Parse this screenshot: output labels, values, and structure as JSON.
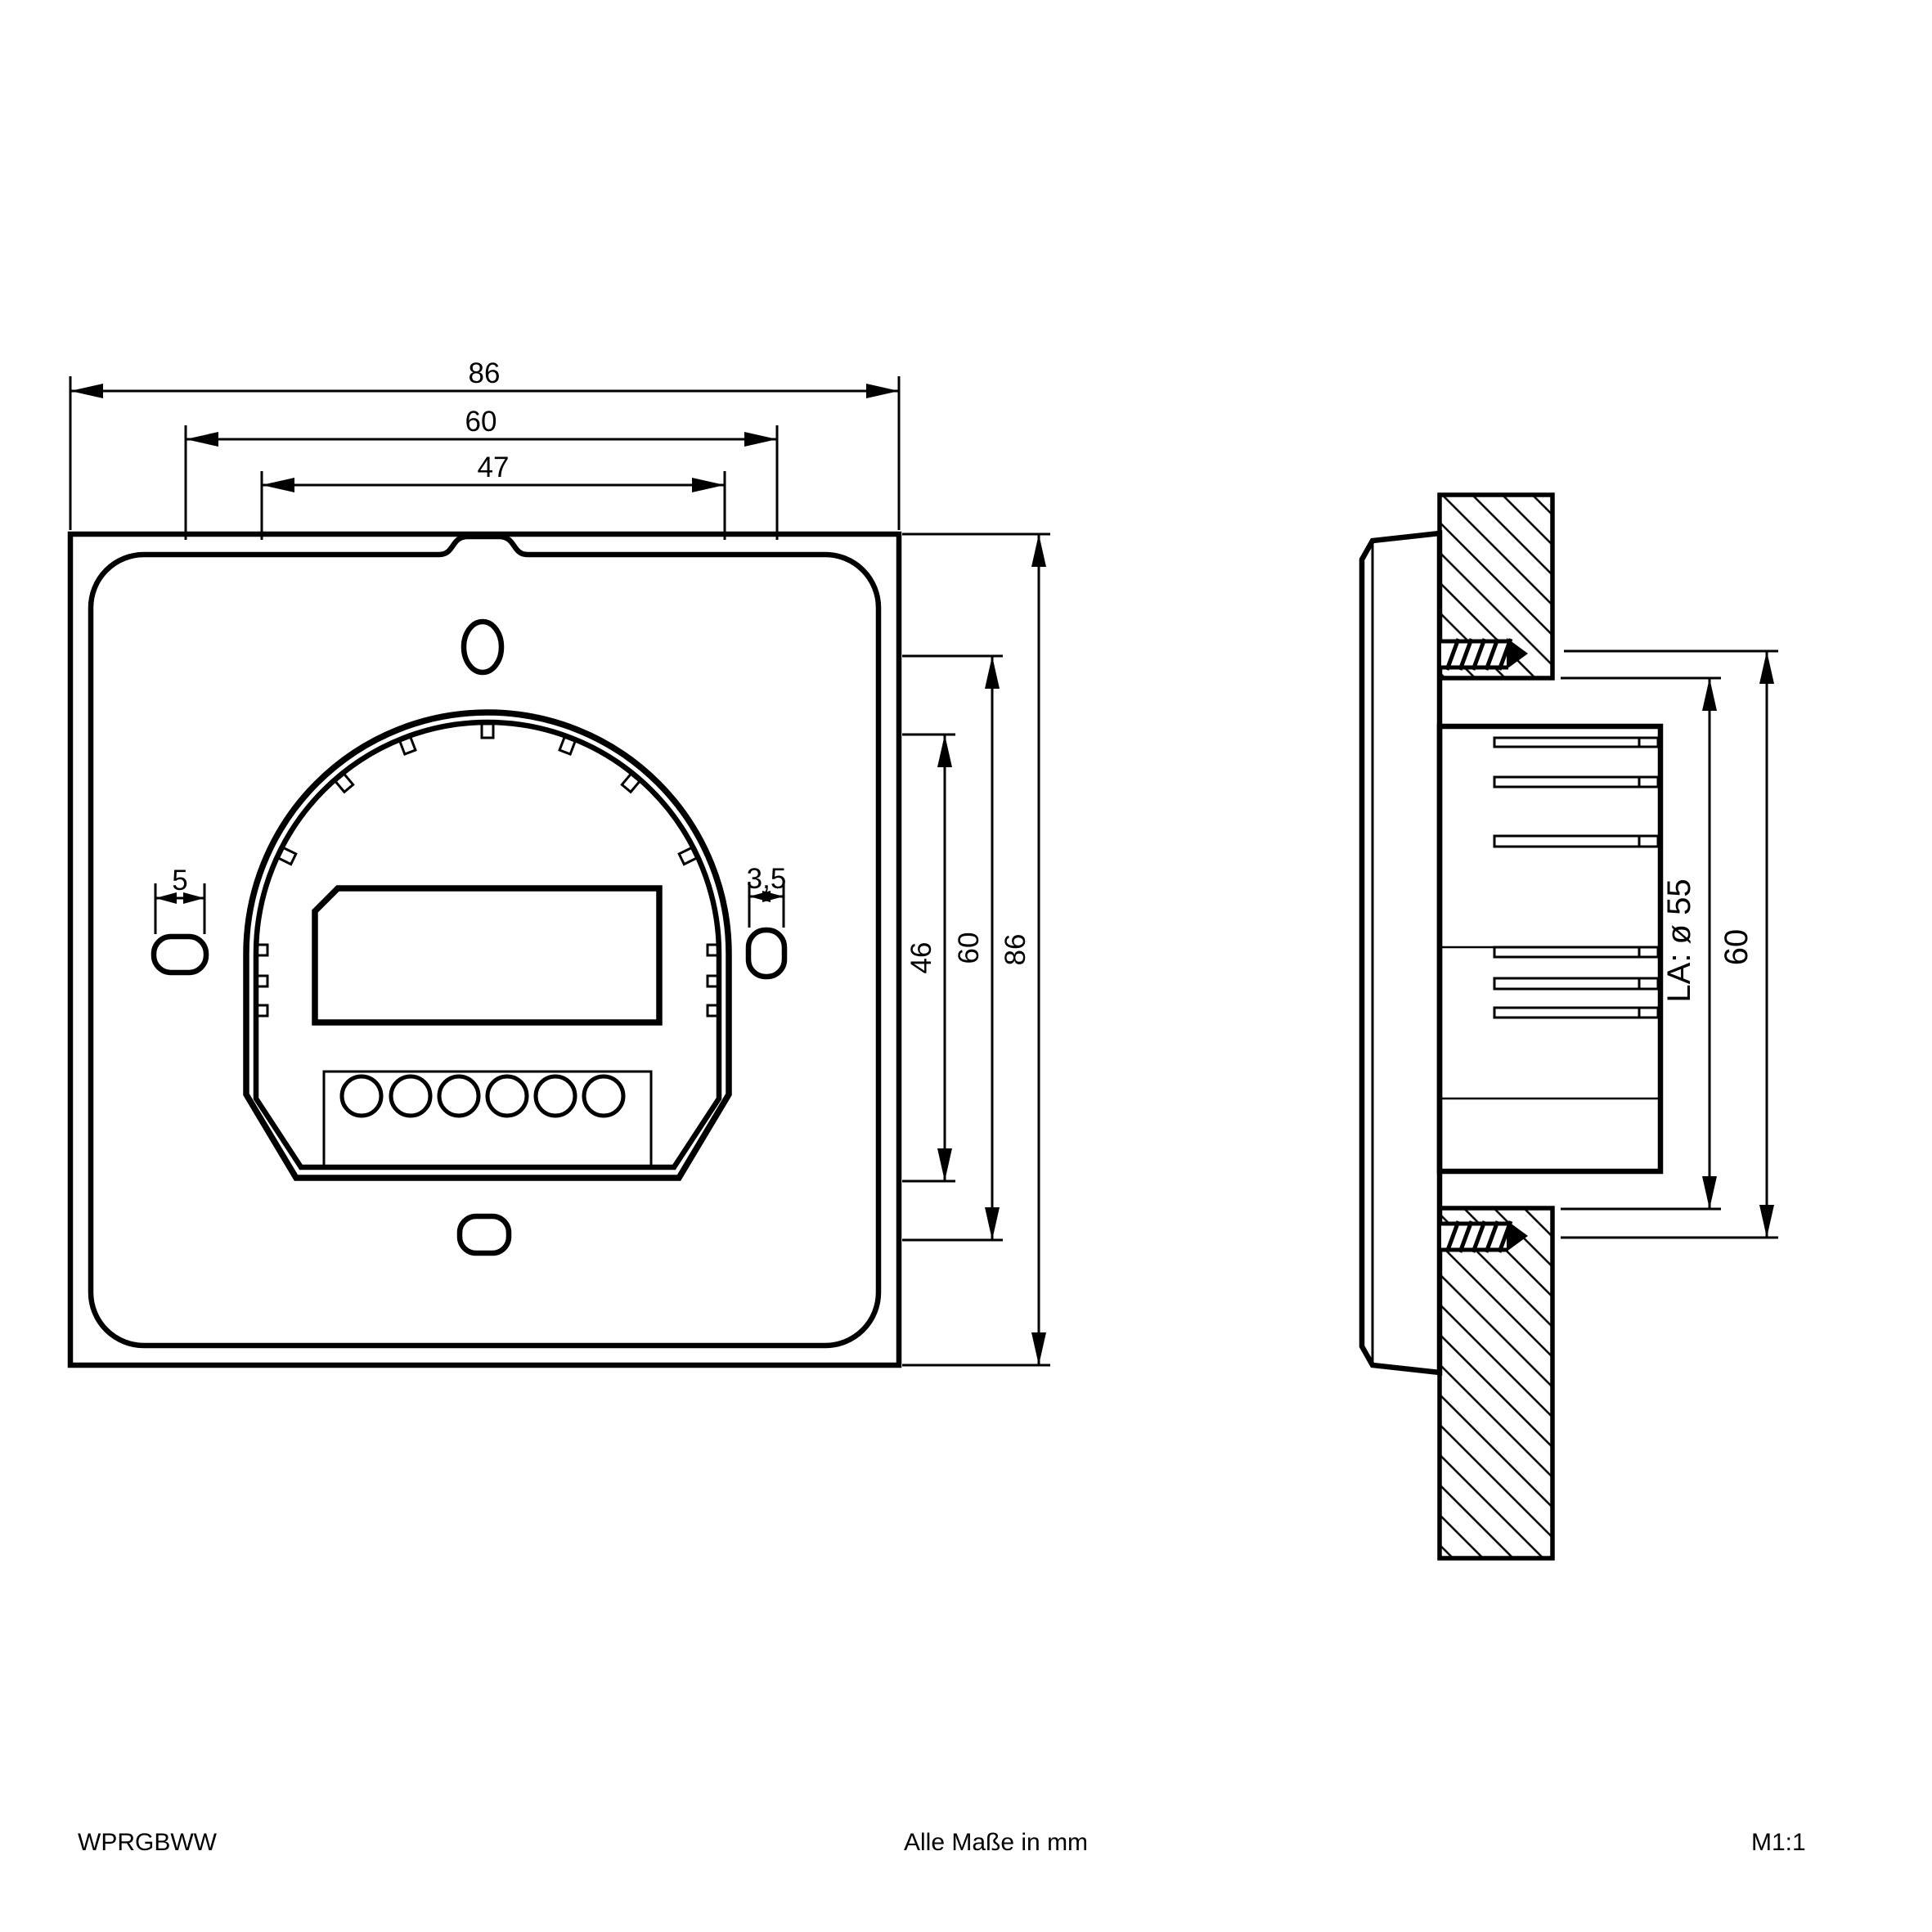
{
  "footer": {
    "product_code": "WPRGBWW",
    "units_note": "Alle Maße in mm",
    "scale": "M1:1"
  },
  "front_view": {
    "dim_width_outer": "86",
    "dim_width_mounting": "60",
    "dim_width_inner": "47",
    "dim_slot_left": "5",
    "dim_slot_right": "3,5",
    "dim_height_inner": "46",
    "dim_height_mounting": "60",
    "dim_height_outer": "86"
  },
  "side_view": {
    "dim_cutout": "LA: ø 55",
    "dim_recess": "60"
  },
  "colors": {
    "line": "#000000",
    "background": "#ffffff"
  }
}
